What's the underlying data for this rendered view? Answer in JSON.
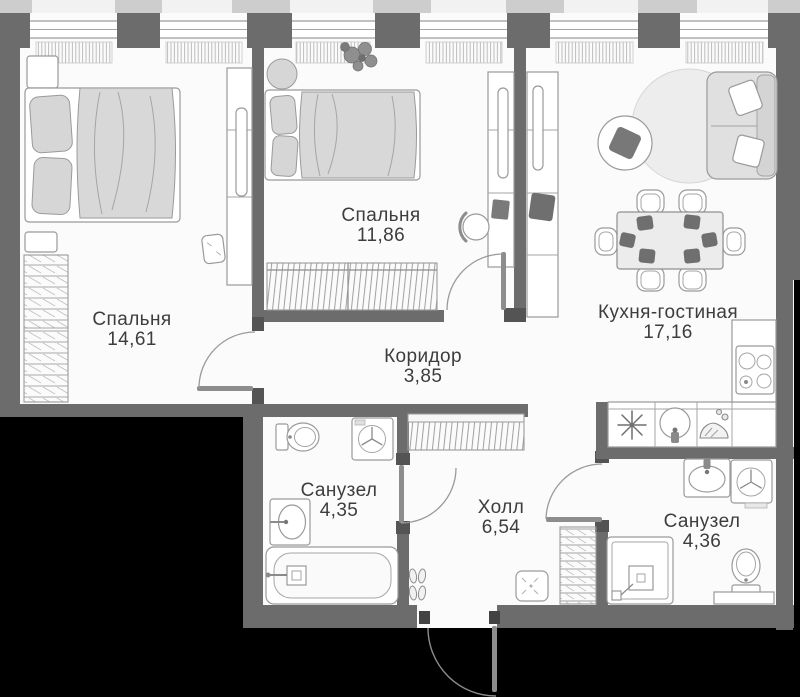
{
  "plan": {
    "colors": {
      "outside": "#000000",
      "wall": "#6c6c6c",
      "floor": "#fbfbfb",
      "text": "#3d3d3d"
    },
    "rooms": [
      {
        "id": "bedroom-1",
        "name": "Спальня",
        "area": "14,61"
      },
      {
        "id": "bedroom-2",
        "name": "Спальня",
        "area": "11,86"
      },
      {
        "id": "corridor",
        "name": "Коридор",
        "area": "3,85"
      },
      {
        "id": "kitchen-living",
        "name": "Кухня-гостиная",
        "area": "17,16"
      },
      {
        "id": "bathroom-1",
        "name": "Санузел",
        "area": "4,35"
      },
      {
        "id": "hall",
        "name": "Холл",
        "area": "6,54"
      },
      {
        "id": "bathroom-2",
        "name": "Санузел",
        "area": "4,36"
      }
    ],
    "icons": {
      "fridge": "snowflake-icon",
      "kitchen_sink": "round-sink-icon",
      "dish_rack": "dish-rack-icon",
      "stove": "four-burner-stove-icon",
      "washing_machine": "washing-machine-icon",
      "bathtub": "bathtub-icon",
      "toilet": "toilet-icon",
      "shower": "shower-tray-icon",
      "radiator": "radiator-hatch-icon",
      "wardrobe": "hanger-hatch-icon"
    }
  }
}
